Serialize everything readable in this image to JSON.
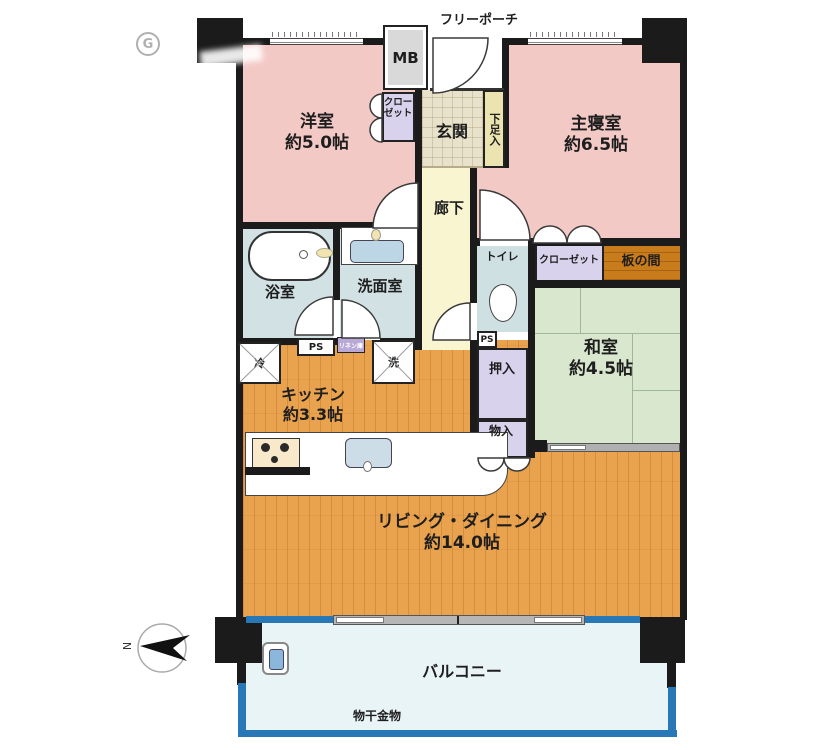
{
  "labels": {
    "free_porch": "フリーポーチ",
    "meter_box": "MB",
    "laundry_hardware": "物干金物"
  },
  "rooms": {
    "western_room": {
      "name": "洋室",
      "size": "約5.0帖"
    },
    "master_bedroom": {
      "name": "主寝室",
      "size": "約6.5帖"
    },
    "japanese_room": {
      "name": "和室",
      "size": "約4.5帖"
    },
    "kitchen": {
      "name": "キッチン",
      "size": "約3.3帖"
    },
    "living_dining": {
      "name": "リビング・ダイニング",
      "size": "約14.0帖"
    },
    "entrance": {
      "name": "玄関"
    },
    "hallway": {
      "name": "廊下"
    },
    "bathroom": {
      "name": "浴室"
    },
    "washroom": {
      "name": "洗面室"
    },
    "toilet": {
      "name": "トイレ"
    },
    "balcony": {
      "name": "バルコニー"
    }
  },
  "storage": {
    "closet_west": "クローゼット",
    "closet_master": "クローゼット",
    "shoe_cabinet": "下足入",
    "futon_closet": "押入",
    "small_storage": "物入",
    "wood_alcove": "板の間",
    "linen": "リネン庫"
  },
  "fixtures": {
    "refrigerator": "冷",
    "washer": "洗",
    "pipe_space_1": "PS",
    "pipe_space_2": "PS"
  },
  "compass": {
    "north": "N"
  },
  "watermark": {
    "letter": "G"
  },
  "colors": {
    "wall": "#1b1b1b",
    "bedroom_pink": "#f3c9c6",
    "tatami_green": "#d9e7cf",
    "flooring": "#e9a24e",
    "alcove_wood": "#c97c1b",
    "closet_purple": "#d8d2ec",
    "wet_area": "#d2e1e4",
    "hallway_yellow": "#f9f5d0",
    "entrance_tile": "#e9e2cb",
    "balcony_blue": "#2878b8",
    "balcony_floor": "#e9f4f7"
  }
}
